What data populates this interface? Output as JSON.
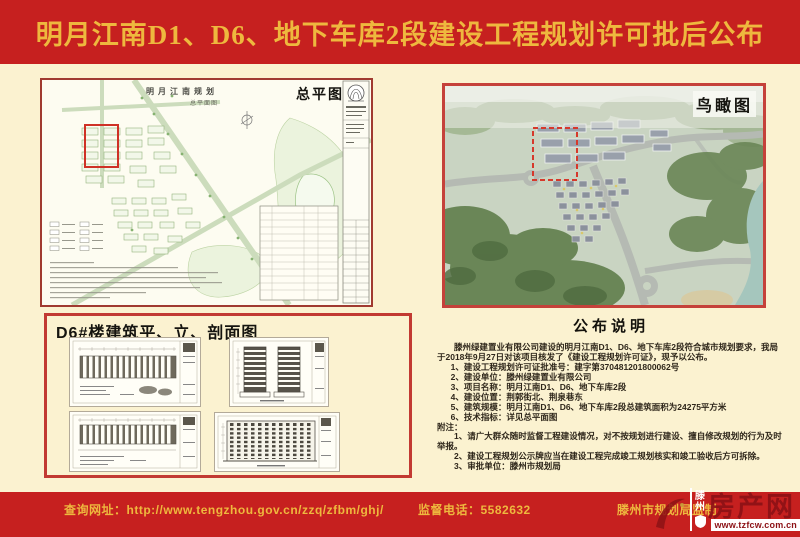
{
  "header": {
    "title": "明月江南D1、D6、地下车库2段建设工程规划许可批后公布"
  },
  "site_plan": {
    "label": "总平图",
    "drawing_title": "明月江南规划",
    "drawing_subtitle": "总平面图"
  },
  "birdseye": {
    "label": "鸟瞰图"
  },
  "d6_panel": {
    "title": "D6#楼建筑平、立、剖面图"
  },
  "announcement": {
    "title": "公布说明",
    "intro": "滕州绿建置业有限公司建设的明月江南D1、D6、地下车库2段符合城市规划要求，我局于2018年9月27日对该项目核发了《建设工程规划许可证》，现予以公布。",
    "items": [
      "1、建设工程规划许可证批准号：建字第370481201800062号",
      "2、建设单位：滕州绿建置业有限公司",
      "3、项目名称：明月江南D1、D6、地下车库2段",
      "4、建设位置：荆郭街北、荆泉巷东",
      "5、建筑规模：明月江南D1、D6、地下车库2段总建筑面积为24275平方米",
      "6、技术指标：详见总平面图"
    ],
    "notes_label": "附注：",
    "notes": [
      "1、请广大群众随时监督工程建设情况，对不按规划进行建设、擅自修改规划的行为及时举报。",
      "2、建设工程规划公示牌应当在建设工程完成竣工规划核实和竣工验收后方可拆除。",
      "3、审批单位：滕州市规划局"
    ]
  },
  "footer": {
    "url_label": "查询网址：http://www.tengzhou.gov.cn/zzq/zfbm/ghj/",
    "phone_label": "监督电话：5582632",
    "producer": "滕州市规划局监制"
  },
  "watermark": {
    "site_name": "滕州",
    "big_text": "房产网",
    "url": "www.tzfcw.com.cn"
  },
  "colors": {
    "banner_red": "#c6201f",
    "title_gold": "#eeb83e",
    "body_cream": "#fbf2d0",
    "highlight_red": "#d6382b",
    "watermark_red": "#8e1216"
  }
}
